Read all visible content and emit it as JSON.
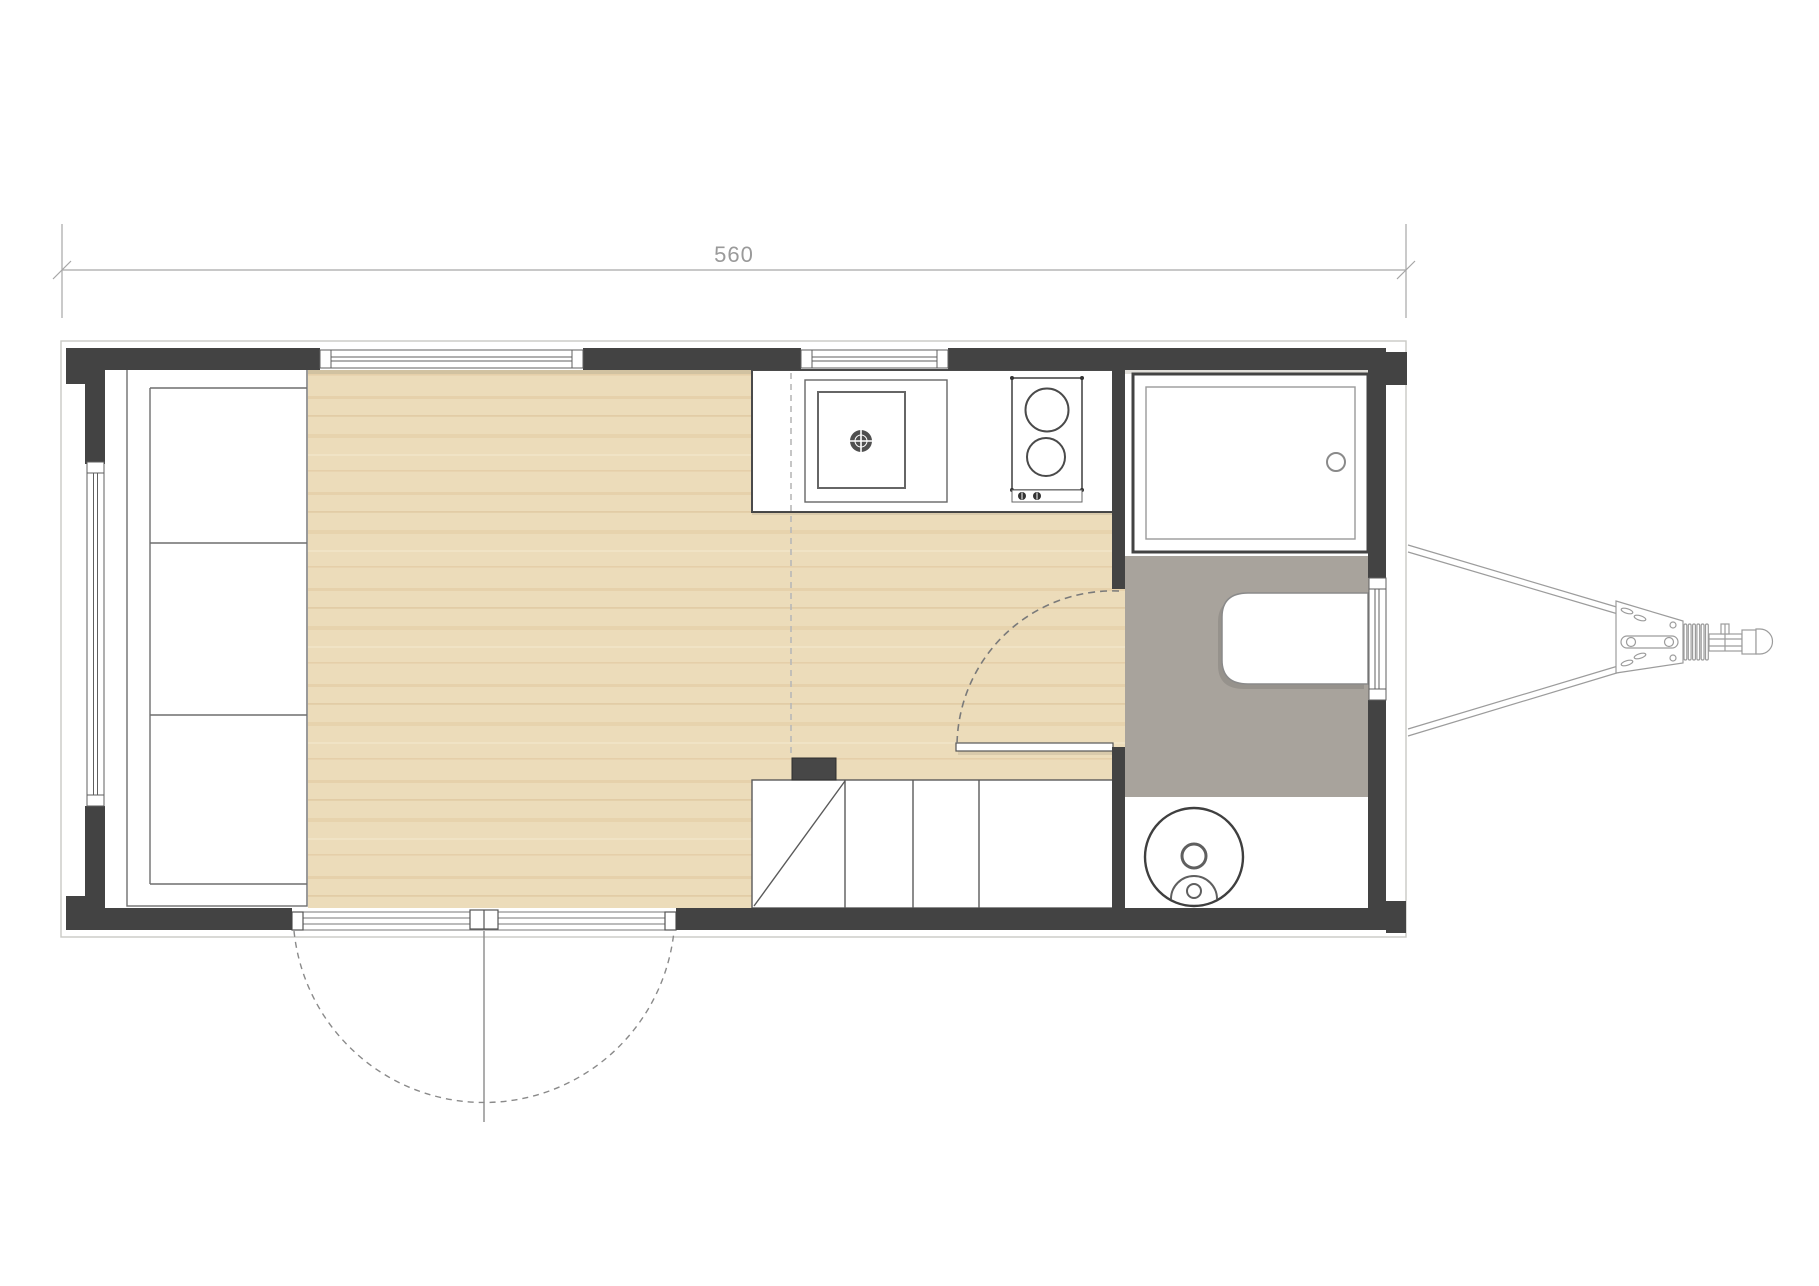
{
  "dimension": {
    "label": "560"
  },
  "colors": {
    "wall": "#434343",
    "wood": "#ecdcba",
    "bath_floor": "#a8a39c",
    "outline": "#c9c9c5",
    "dim_line": "#a6a6a6",
    "dim_text": "#9a9a9a",
    "fixture": "#5f5f5f",
    "hitch": "#9c9c9c",
    "background": "#ffffff"
  },
  "plan": {
    "type": "tiny-house-trailer-floor-plan",
    "rooms": [
      "living-area",
      "kitchen",
      "bathroom"
    ],
    "fixtures": [
      "sofa-bed",
      "kitchen-counter",
      "sink",
      "cooktop-2-burner",
      "stairs",
      "shower",
      "vanity",
      "composting-toilet",
      "entry-double-door",
      "bathroom-door",
      "trailer-hitch"
    ],
    "windows": [
      "top-left-window",
      "top-kitchen-window",
      "left-wall-window",
      "right-wall-window"
    ]
  }
}
